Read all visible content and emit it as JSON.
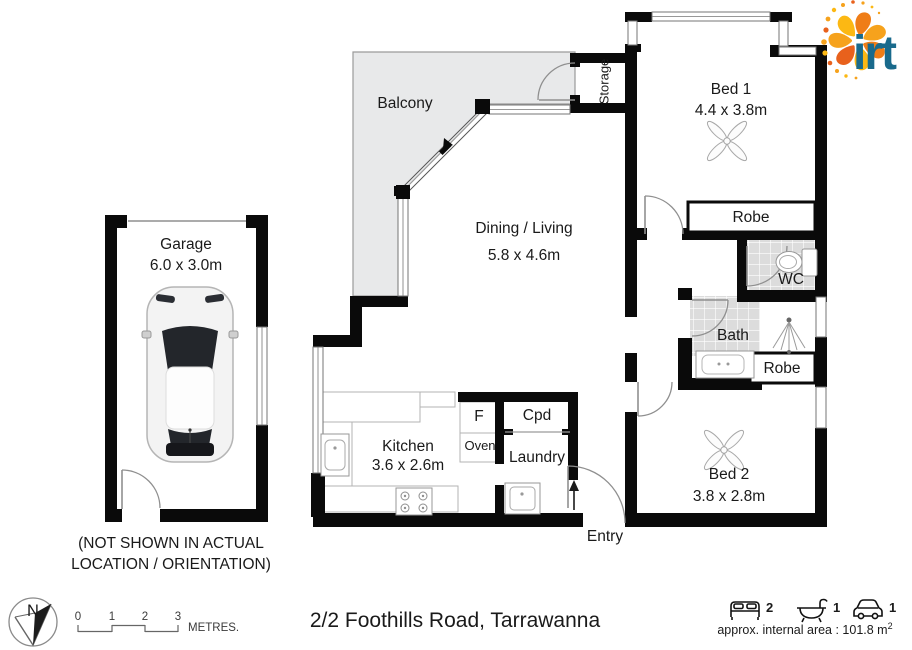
{
  "title": {
    "address": "2/2 Foothills Road, Tarrawanna"
  },
  "rooms": {
    "garage": {
      "name": "Garage",
      "dims": "6.0 x 3.0m"
    },
    "balcony": {
      "name": "Balcony"
    },
    "storage": {
      "name": "Storage"
    },
    "dining": {
      "name": "Dining / Living",
      "dims": "5.8 x 4.6m"
    },
    "bed1": {
      "name": "Bed 1",
      "dims": "4.4 x 3.8m"
    },
    "robe1": {
      "name": "Robe"
    },
    "wc": {
      "name": "WC"
    },
    "bath": {
      "name": "Bath"
    },
    "robe2": {
      "name": "Robe"
    },
    "bed2": {
      "name": "Bed 2",
      "dims": "3.8 x 2.8m"
    },
    "kitchen": {
      "name": "Kitchen",
      "dims": "3.6 x 2.6m"
    },
    "fridge": {
      "name": "F"
    },
    "oven": {
      "name": "Oven"
    },
    "cupboard": {
      "name": "Cpd"
    },
    "laundry": {
      "name": "Laundry"
    },
    "entry": {
      "name": "Entry"
    }
  },
  "garage_note": {
    "line1": "(NOT SHOWN IN ACTUAL",
    "line2": "LOCATION / ORIENTATION)"
  },
  "compass": {
    "label": "N"
  },
  "scale_bar": {
    "ticks": [
      "0",
      "1",
      "2",
      "3"
    ],
    "unit": "METRES."
  },
  "stats": {
    "beds": "2",
    "baths": "1",
    "cars": "1",
    "area_label": "approx. internal area : 101.8 m",
    "area_sup": "2"
  },
  "logo": {
    "text": "irt"
  },
  "colors": {
    "wall": "#0a0a0a",
    "balcony_floor": "#e8e9ea",
    "tile": "#dcdcdc",
    "logo_teal": "#196a8c",
    "logo_orange": "#f6a21c"
  }
}
